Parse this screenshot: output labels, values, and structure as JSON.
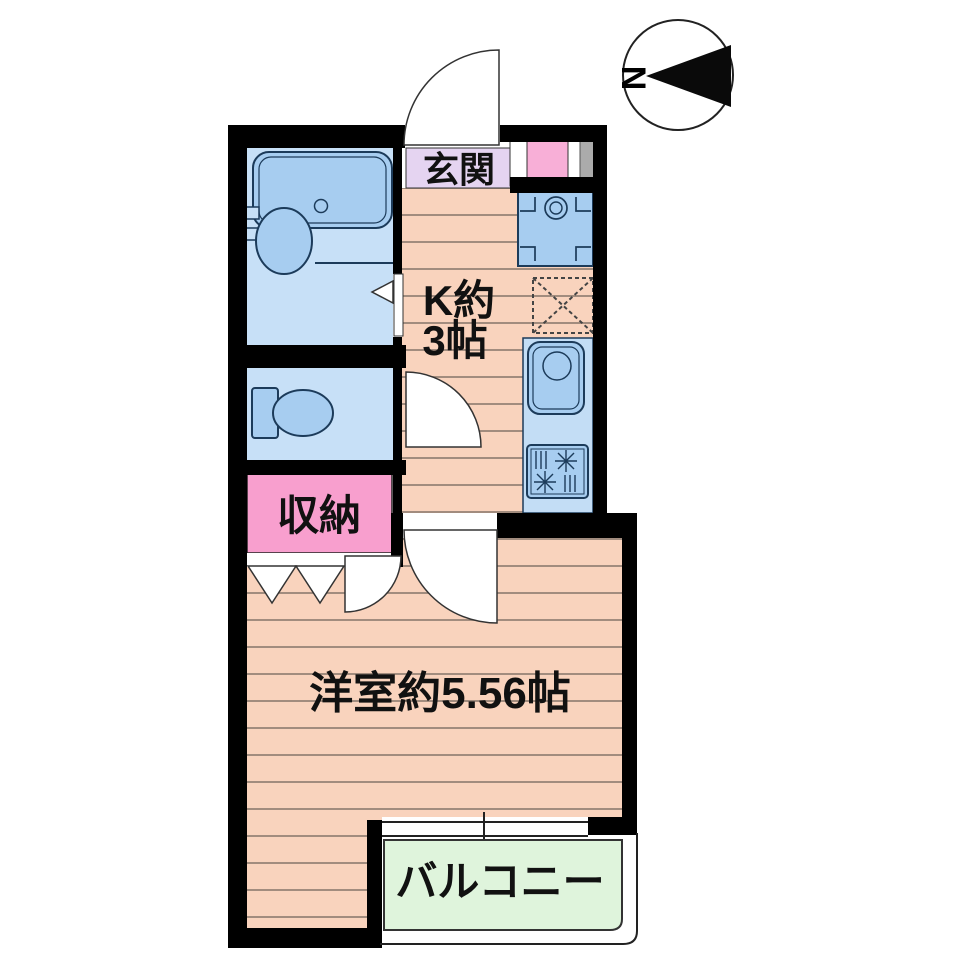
{
  "document": {
    "kind": "Japanese apartment floor plan (1K unit)"
  },
  "compass": {
    "north_label": "N",
    "arrow_points": "left"
  },
  "plan": {
    "entrance": {
      "label": "玄関"
    },
    "kitchen": {
      "label": [
        "K約",
        "3帖"
      ]
    },
    "storage": {
      "label": "収納"
    },
    "western_room": {
      "label": "洋室約5.56帖"
    },
    "balcony": {
      "label": "バルコニー"
    },
    "bathroom": {
      "fixtures": [
        "bathtub",
        "washbasin"
      ]
    },
    "toilet": {
      "fixtures": [
        "toilet"
      ]
    },
    "equipment": [
      "washing-machine-space",
      "refrigerator-space",
      "kitchen-sink",
      "gas-stove",
      "shoe-cabinet"
    ]
  },
  "colors": {
    "wall": "#000000",
    "floor": "#F9D3BD",
    "floorline": "#8C7A6E",
    "fixturefill": "#A7CDF0",
    "fixturestroke": "#1C3B5A",
    "roomblue": "#C7E0F7",
    "counterblue": "#C3DDF5",
    "genkan": "#E5D4F1",
    "storagepink": "#F89FCE",
    "shoepink": "#F8AFD7",
    "balconygreen": "#DFF4DC",
    "grayitem": "#ABABAB"
  }
}
